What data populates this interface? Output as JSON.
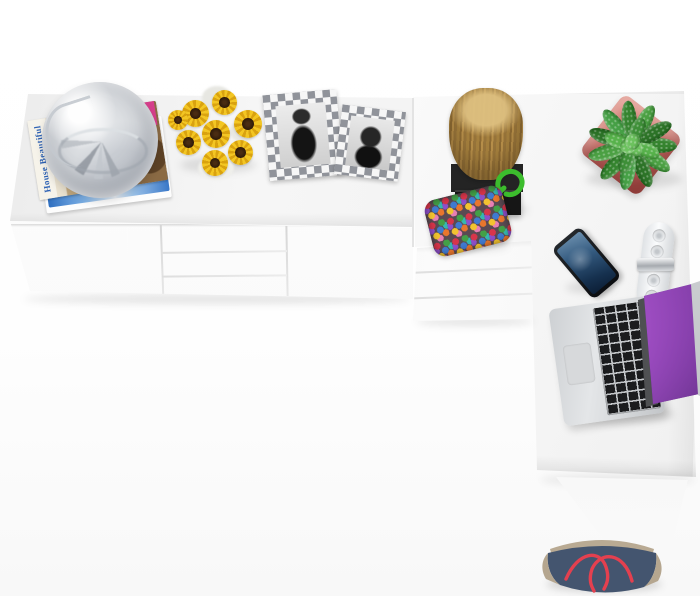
{
  "scene": {
    "title": "White L-shaped desk and sideboard with decor, top view",
    "background_color": "#ffffff"
  },
  "furniture": {
    "sideboard": {
      "color": "#ffffff",
      "doors": 2,
      "drawers": 3
    },
    "desk": {
      "color": "#ffffff",
      "drawers": 3,
      "shape": "L-shaped"
    }
  },
  "decor": {
    "magazine": {
      "title": "House Beautiful",
      "title_color": "#2e62b4",
      "description": "stack of magazines"
    },
    "glass_sphere": {
      "description": "glass sphere ice bucket on magazines",
      "color": "#d4d7db"
    },
    "sunflowers": {
      "description": "sunflower bouquet in white vase",
      "petal_color": "#f3c623",
      "center_color": "#3a2512"
    },
    "frames": {
      "description": "two checkered frames with black and white portrait photos",
      "checker_colors": [
        "#f6f6f6",
        "#90939a"
      ]
    },
    "stump": {
      "description": "wood log sculpture on black plinth",
      "wood_color": "#a5803e",
      "base_color": "#1c1c1c"
    },
    "plant": {
      "description": "green succulent plant in square pink pot",
      "leaf_color": "#3f9a3c",
      "pot_color": "#c4706a"
    },
    "pouch": {
      "description": "multicolor beaded pouch with green cord loop",
      "cord_color": "#3cbd2d"
    },
    "phone": {
      "description": "smartphone with blue lock screen",
      "body_color": "#14181c",
      "screen_color": "#33597e"
    },
    "power_strip": {
      "description": "white power strip with round sockets and metal band",
      "color": "#e8eaec"
    },
    "laptop": {
      "description": "silver laptop with purple galaxy wallpaper",
      "body_color": "#c9cccf",
      "screen_color": "#8a3fb0"
    },
    "bag": {
      "description": "navy and taupe tote bag with red rope handles on floor",
      "body_color": "#44556f",
      "trim_color": "#b5a68f",
      "handle_color": "#e4404f"
    }
  }
}
